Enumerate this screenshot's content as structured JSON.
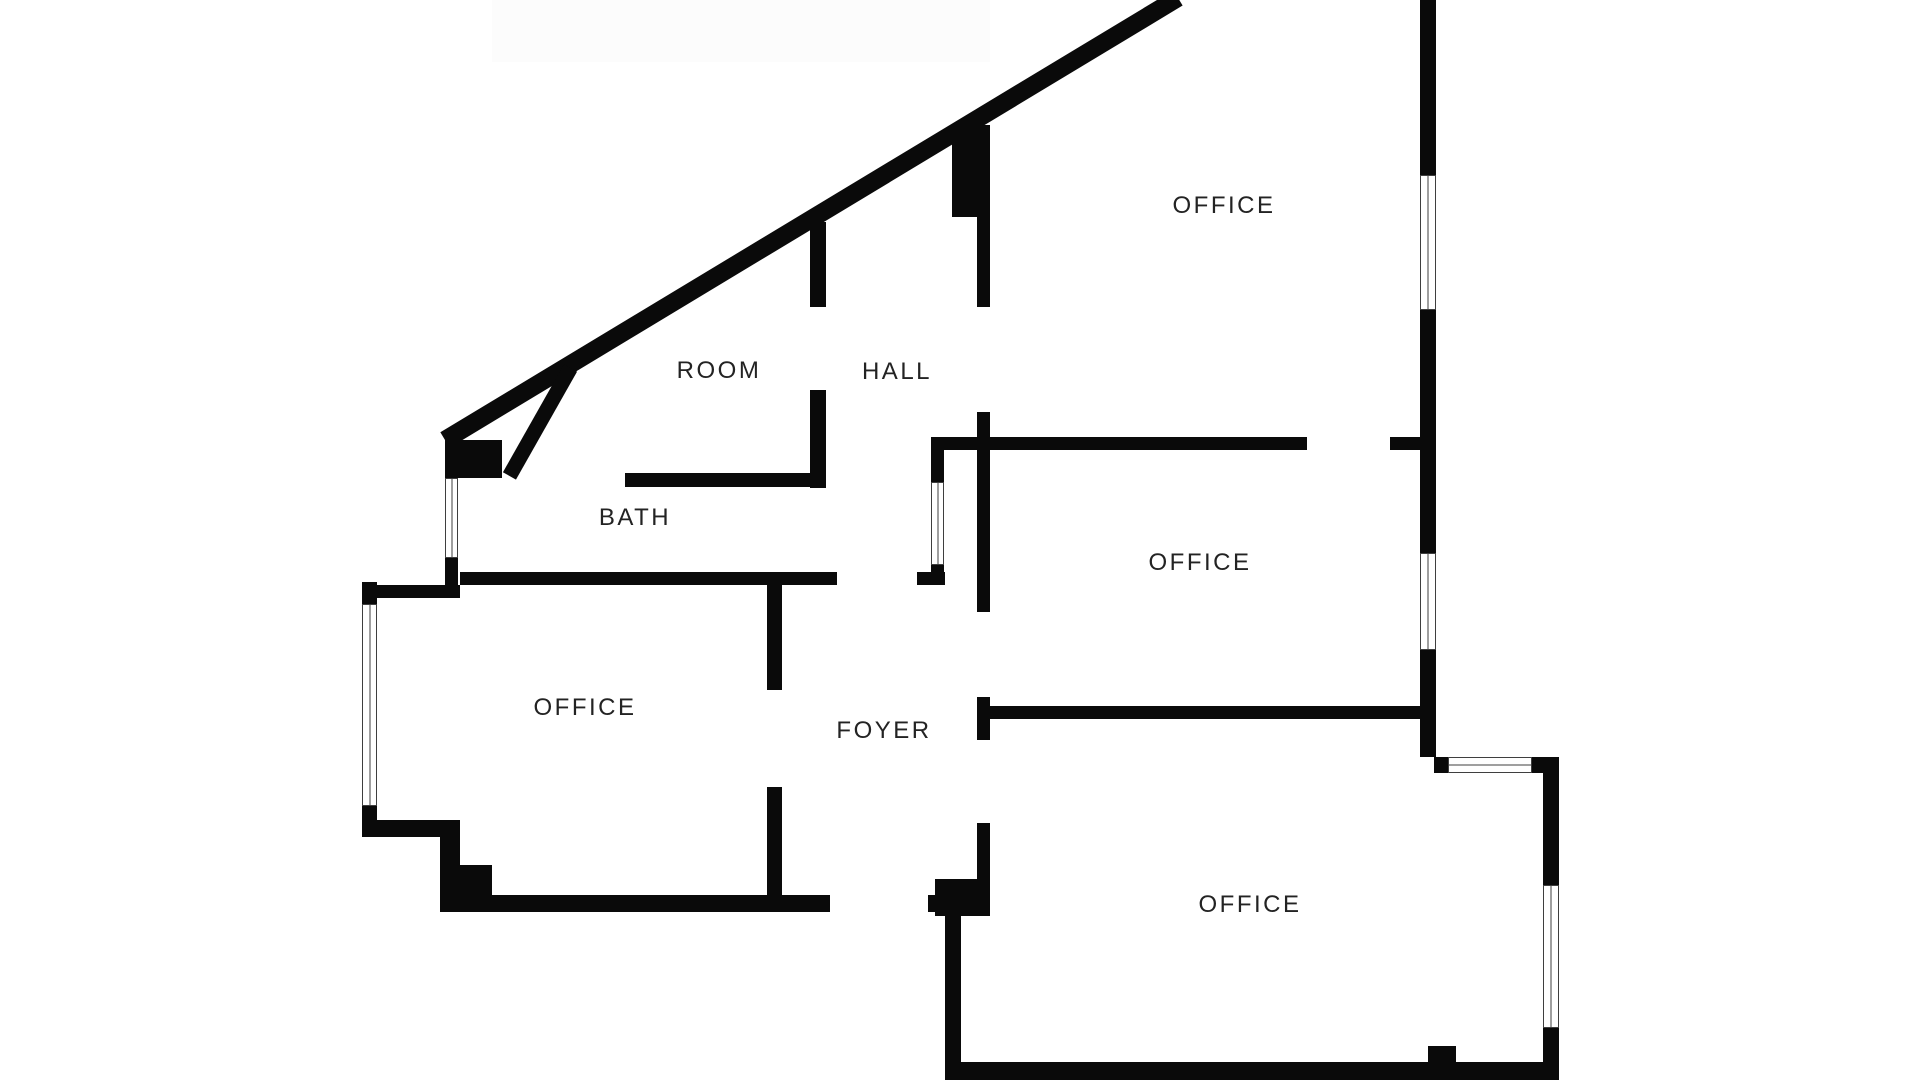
{
  "title": "Floor plan",
  "colors": {
    "wall": "#0a0a0a",
    "background": "#ffffff",
    "label": "#232323",
    "window_frame": "#3f3f3f",
    "shade_band": "#fcfcfc"
  },
  "rooms": [
    {
      "id": "office-top",
      "label": "OFFICE"
    },
    {
      "id": "room",
      "label": "ROOM"
    },
    {
      "id": "hall",
      "label": "HALL"
    },
    {
      "id": "bath",
      "label": "BATH"
    },
    {
      "id": "office-middle",
      "label": "OFFICE"
    },
    {
      "id": "office-left",
      "label": "OFFICE"
    },
    {
      "id": "foyer",
      "label": "FOYER"
    },
    {
      "id": "office-bottom",
      "label": "OFFICE"
    }
  ]
}
